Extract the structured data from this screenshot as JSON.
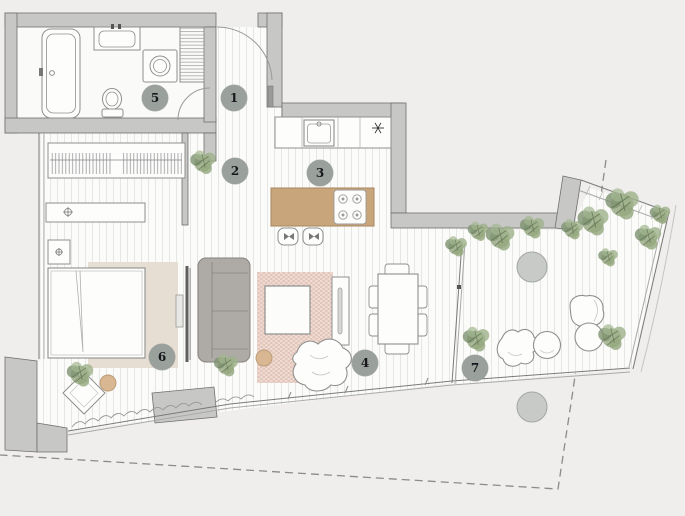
{
  "plan": {
    "markers": [
      {
        "number": "1"
      },
      {
        "number": "2"
      },
      {
        "number": "3"
      },
      {
        "number": "4"
      },
      {
        "number": "5"
      },
      {
        "number": "6"
      },
      {
        "number": "7"
      }
    ],
    "icons": {
      "freezer": "snowflake-icon",
      "stools": "woven-seat-icon",
      "lamps": "light-fixture-icon"
    },
    "colors": {
      "background": "#efeeec",
      "wall_fill": "#c7c7c5",
      "wall_outline": "#6f6f6d",
      "floor": "#fbfbf9",
      "floor_stripe": "#e6e6e4",
      "wood_island": "#c9a57c",
      "bedroom_rug": "#e6ddd3",
      "living_rug": "#e2c6bc",
      "sofa_gray": "#aeaaa5",
      "plant_green": "#8da077",
      "marker_circle": "#9aa09c",
      "pouf_tan": "#d9b793",
      "boundary_dashed": "#8b8b89"
    }
  }
}
